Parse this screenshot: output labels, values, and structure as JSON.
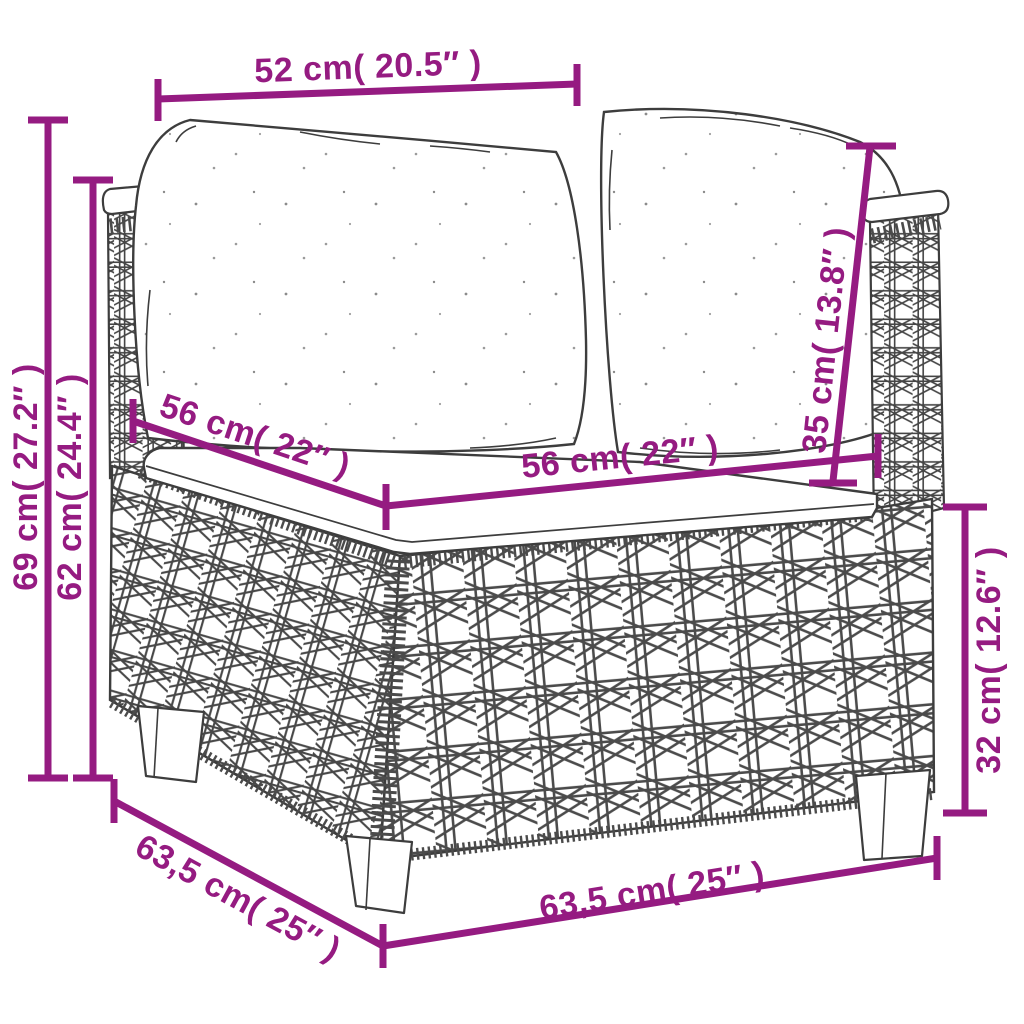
{
  "diagram": {
    "accent_color": "#951b81",
    "line_color": "#3d3d3d",
    "illustration": "wicker-corner-sofa-with-cushions",
    "labels": {
      "top_width": "52 cm( 20.5″ )",
      "overall_height": "69 cm( 27.2″ )",
      "arm_height": "62 cm( 24.4″ )",
      "back_cushion_height": "35 cm( 13.8″ )",
      "seat_depth": "56 cm( 22″ )",
      "seat_width": "56 cm( 22″ )",
      "seat_to_ground_height": "32 cm( 12.6″ )",
      "base_depth": "63,5 cm( 25″ )",
      "base_width": "63,5 cm( 25″ )"
    }
  }
}
